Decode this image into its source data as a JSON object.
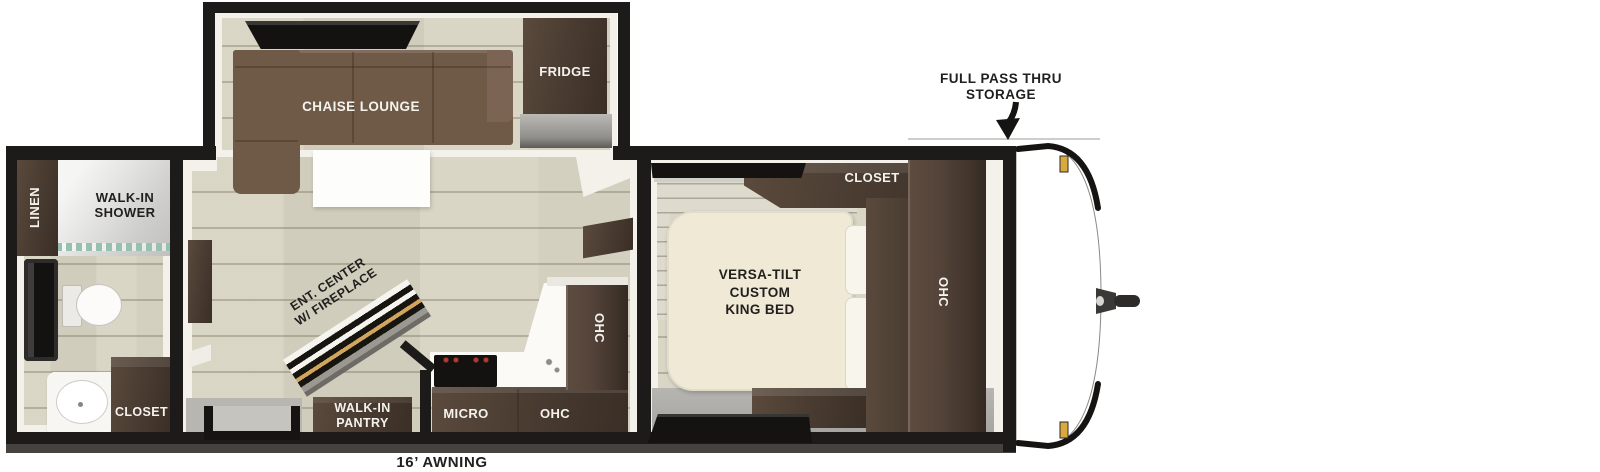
{
  "plan": {
    "awning_label": "16’ AWNING",
    "exterior": {
      "storage_line1": "FULL PASS THRU",
      "storage_line2": "STORAGE"
    },
    "living_area": {
      "chaise_lounge": "CHAISE LOUNGE",
      "fridge": "FRIDGE",
      "ent_center_line1": "ENT. CENTER",
      "ent_center_line2": "W/ FIREPLACE",
      "pantry_line1": "WALK-IN",
      "pantry_line2": "PANTRY",
      "micro": "MICRO",
      "ohc_base": "OHC",
      "ohc_tall": "OHC"
    },
    "bathroom": {
      "linen": "LINEN",
      "shower_line1": "WALK-IN",
      "shower_line2": "SHOWER",
      "closet": "CLOSET"
    },
    "bedroom": {
      "closet": "CLOSET",
      "bed_line1": "VERSA-TILT",
      "bed_line2": "CUSTOM",
      "bed_line3": "KING BED",
      "ohc": "OHC"
    },
    "colors": {
      "wall_black": "#1d1b19",
      "floor_beige": "#d8d4c3",
      "dark_wood": "#4a3c31",
      "sofa_brown": "#6f5947",
      "bed_cream": "#efe9d6",
      "counter_gray": "#a3a19d",
      "accent_gold": "#d9a93e",
      "glass_teal": "#97c0b1"
    }
  }
}
